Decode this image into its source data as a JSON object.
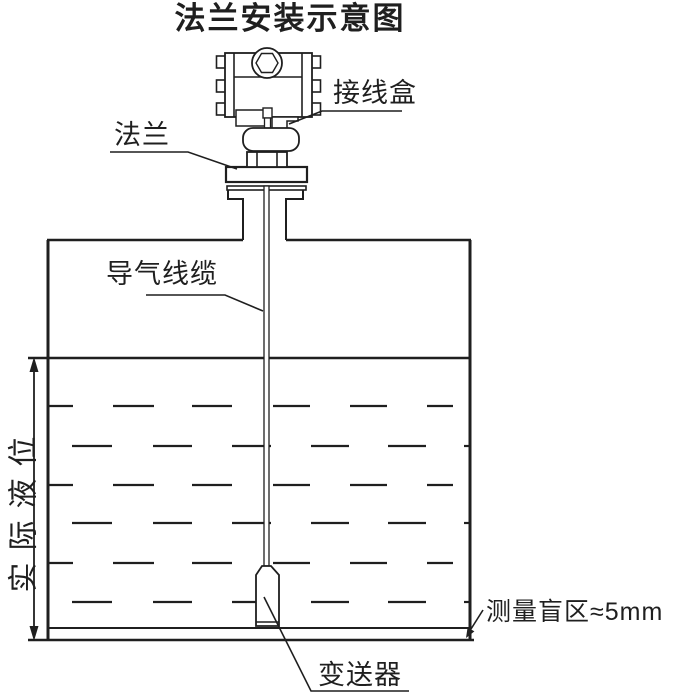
{
  "title": "法兰安装示意图",
  "labels": {
    "junction_box": "接线盒",
    "flange": "法兰",
    "air_cable": "导气线缆",
    "actual_level": "实际液位",
    "transmitter": "变送器",
    "blind_zone": "测量盲区≈5mm"
  },
  "colors": {
    "line": "#1f1f1f",
    "background": "#ffffff"
  }
}
